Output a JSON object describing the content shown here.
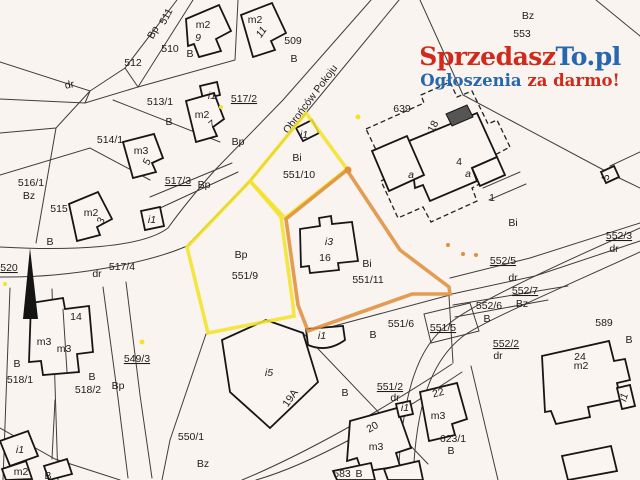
{
  "watermark": {
    "line1": [
      {
        "text": "Sprzedasz",
        "color": "#cf2a1b"
      },
      {
        "text": "To.pl",
        "color": "#2767ae"
      }
    ],
    "line2": [
      {
        "text": "Ogłoszenia ",
        "color": "#2767ae"
      },
      {
        "text": "za darmo!",
        "color": "#cf2a1b"
      }
    ]
  },
  "map": {
    "street_name": "Obrońców Pokoju",
    "highlight_colors": {
      "yellow": "#f3e32c",
      "orange": "#df8f3e"
    },
    "highlighted_parcels": [
      "551/9",
      "551/10",
      "551/11"
    ],
    "labels": [
      {
        "t": "511",
        "x": 169,
        "y": 18,
        "r": -62
      },
      {
        "t": "Bp",
        "x": 156,
        "y": 34,
        "r": -62
      },
      {
        "t": "m2",
        "x": 203,
        "y": 28
      },
      {
        "t": "9",
        "x": 198,
        "y": 41,
        "i": 1
      },
      {
        "t": "510",
        "x": 170,
        "y": 52
      },
      {
        "t": "B",
        "x": 190,
        "y": 57
      },
      {
        "t": "512",
        "x": 133,
        "y": 66
      },
      {
        "t": "dr",
        "x": 70,
        "y": 88,
        "r": -10
      },
      {
        "t": "m2",
        "x": 255,
        "y": 23
      },
      {
        "t": "11",
        "x": 264,
        "y": 34,
        "i": 1,
        "r": -55
      },
      {
        "t": "509",
        "x": 293,
        "y": 44
      },
      {
        "t": "B",
        "x": 294,
        "y": 62
      },
      {
        "t": "Bz",
        "x": 528,
        "y": 19
      },
      {
        "t": "553",
        "x": 522,
        "y": 37
      },
      {
        "t": "i1",
        "x": 212,
        "y": 99,
        "i": 1
      },
      {
        "t": "517/2",
        "x": 244,
        "y": 102,
        "u": 1
      },
      {
        "t": "513/1",
        "x": 160,
        "y": 105
      },
      {
        "t": "B",
        "x": 169,
        "y": 125
      },
      {
        "t": "m2",
        "x": 202,
        "y": 118
      },
      {
        "t": "7",
        "x": 214,
        "y": 127,
        "i": 1,
        "r": -40
      },
      {
        "t": "514/1",
        "x": 110,
        "y": 143
      },
      {
        "t": "m3",
        "x": 141,
        "y": 154
      },
      {
        "t": "5",
        "x": 150,
        "y": 163,
        "i": 1,
        "r": -70
      },
      {
        "t": "Obrońców Pokoju",
        "x": 313,
        "y": 101,
        "r": -53,
        "s": 11
      },
      {
        "t": "Bp",
        "x": 238,
        "y": 145
      },
      {
        "t": "639",
        "x": 402,
        "y": 112
      },
      {
        "t": "18",
        "x": 436,
        "y": 128,
        "r": -62
      },
      {
        "t": "a",
        "x": 411,
        "y": 178,
        "i": 1
      },
      {
        "t": "4",
        "x": 459,
        "y": 165
      },
      {
        "t": "a",
        "x": 468,
        "y": 177,
        "i": 1
      },
      {
        "t": "1",
        "x": 492,
        "y": 201
      },
      {
        "t": "Bi",
        "x": 513,
        "y": 226
      },
      {
        "t": "5",
        "x": 609,
        "y": 178,
        "r": -75
      },
      {
        "t": "516/1",
        "x": 31,
        "y": 186
      },
      {
        "t": "Bz",
        "x": 29,
        "y": 199
      },
      {
        "t": "517/3",
        "x": 178,
        "y": 184,
        "u": 1
      },
      {
        "t": "Bp",
        "x": 204,
        "y": 188
      },
      {
        "t": "515",
        "x": 59,
        "y": 212
      },
      {
        "t": "m2",
        "x": 91,
        "y": 216
      },
      {
        "t": "3",
        "x": 104,
        "y": 222,
        "i": 1,
        "r": -70
      },
      {
        "t": "i1",
        "x": 152,
        "y": 223,
        "i": 1
      },
      {
        "t": "B",
        "x": 50,
        "y": 245
      },
      {
        "t": "520",
        "x": 9,
        "y": 271,
        "u": 1
      },
      {
        "t": "517/4",
        "x": 122,
        "y": 270
      },
      {
        "t": "dr",
        "x": 97,
        "y": 277
      },
      {
        "t": "i1",
        "x": 304,
        "y": 138,
        "i": 1
      },
      {
        "t": "Bi",
        "x": 297,
        "y": 161
      },
      {
        "t": "551/10",
        "x": 299,
        "y": 178
      },
      {
        "t": "Bp",
        "x": 241,
        "y": 258
      },
      {
        "t": "551/9",
        "x": 245,
        "y": 279
      },
      {
        "t": "i3",
        "x": 329,
        "y": 245,
        "i": 1
      },
      {
        "t": "16",
        "x": 325,
        "y": 261
      },
      {
        "t": "Bi",
        "x": 367,
        "y": 267
      },
      {
        "t": "551/11",
        "x": 368,
        "y": 283
      },
      {
        "t": "552/3",
        "x": 619,
        "y": 239,
        "u": 1
      },
      {
        "t": "dr",
        "x": 614,
        "y": 252
      },
      {
        "t": "552/5",
        "x": 503,
        "y": 264,
        "u": 1
      },
      {
        "t": "dr",
        "x": 513,
        "y": 281
      },
      {
        "t": "552/7",
        "x": 525,
        "y": 294,
        "u": 1
      },
      {
        "t": "Bz",
        "x": 522,
        "y": 307
      },
      {
        "t": "552/6",
        "x": 489,
        "y": 309
      },
      {
        "t": "B",
        "x": 487,
        "y": 322
      },
      {
        "t": "589",
        "x": 604,
        "y": 326
      },
      {
        "t": "B",
        "x": 629,
        "y": 343
      },
      {
        "t": "551/6",
        "x": 401,
        "y": 327
      },
      {
        "t": "B",
        "x": 373,
        "y": 338
      },
      {
        "t": "551/5",
        "x": 443,
        "y": 331,
        "u": 1
      },
      {
        "t": "552/2",
        "x": 506,
        "y": 347,
        "u": 1
      },
      {
        "t": "dr",
        "x": 498,
        "y": 359
      },
      {
        "t": "14",
        "x": 76,
        "y": 320
      },
      {
        "t": "m3",
        "x": 44,
        "y": 345
      },
      {
        "t": "m3",
        "x": 64,
        "y": 352
      },
      {
        "t": "549/3",
        "x": 137,
        "y": 362,
        "u": 1
      },
      {
        "t": "B",
        "x": 17,
        "y": 367
      },
      {
        "t": "518/1",
        "x": 20,
        "y": 383
      },
      {
        "t": "B",
        "x": 92,
        "y": 380
      },
      {
        "t": "518/2",
        "x": 88,
        "y": 393
      },
      {
        "t": "Bp",
        "x": 118,
        "y": 389
      },
      {
        "t": "i5",
        "x": 269,
        "y": 376,
        "i": 1
      },
      {
        "t": "19A",
        "x": 293,
        "y": 400,
        "r": -55
      },
      {
        "t": "i1",
        "x": 322,
        "y": 339,
        "i": 1
      },
      {
        "t": "B",
        "x": 345,
        "y": 396
      },
      {
        "t": "551/2",
        "x": 390,
        "y": 390,
        "u": 1
      },
      {
        "t": "dr",
        "x": 395,
        "y": 401
      },
      {
        "t": "i1",
        "x": 405,
        "y": 411,
        "i": 1
      },
      {
        "t": "20",
        "x": 374,
        "y": 430,
        "r": -30
      },
      {
        "t": "m3",
        "x": 376,
        "y": 450
      },
      {
        "t": "583",
        "x": 342,
        "y": 477
      },
      {
        "t": "B",
        "x": 359,
        "y": 477
      },
      {
        "t": "22",
        "x": 439,
        "y": 396,
        "r": -15
      },
      {
        "t": "m3",
        "x": 438,
        "y": 419
      },
      {
        "t": "623/1",
        "x": 453,
        "y": 442
      },
      {
        "t": "B",
        "x": 451,
        "y": 454
      },
      {
        "t": "24",
        "x": 580,
        "y": 360
      },
      {
        "t": "m2",
        "x": 581,
        "y": 369
      },
      {
        "t": "i1",
        "x": 627,
        "y": 398,
        "i": 1,
        "r": -75
      },
      {
        "t": "i1",
        "x": 20,
        "y": 453,
        "i": 1
      },
      {
        "t": "m2",
        "x": 21,
        "y": 475
      },
      {
        "t": "B",
        "x": 48,
        "y": 479
      },
      {
        "t": "550/1",
        "x": 191,
        "y": 440
      },
      {
        "t": "Bz",
        "x": 203,
        "y": 467
      }
    ],
    "dots": [
      {
        "x": 358,
        "y": 117,
        "c": "yellow",
        "r": 2.5
      },
      {
        "x": 221,
        "y": 107,
        "c": "yellow",
        "r": 2
      },
      {
        "x": 5,
        "y": 284,
        "c": "yellow",
        "r": 2
      },
      {
        "x": 142,
        "y": 342,
        "c": "yellow",
        "r": 2.5
      },
      {
        "x": 348,
        "y": 170,
        "c": "orange",
        "r": 3.5
      },
      {
        "x": 448,
        "y": 245,
        "c": "orange",
        "r": 2
      },
      {
        "x": 463,
        "y": 254,
        "c": "orange",
        "r": 2
      },
      {
        "x": 476,
        "y": 255,
        "c": "orange",
        "r": 2
      }
    ]
  }
}
